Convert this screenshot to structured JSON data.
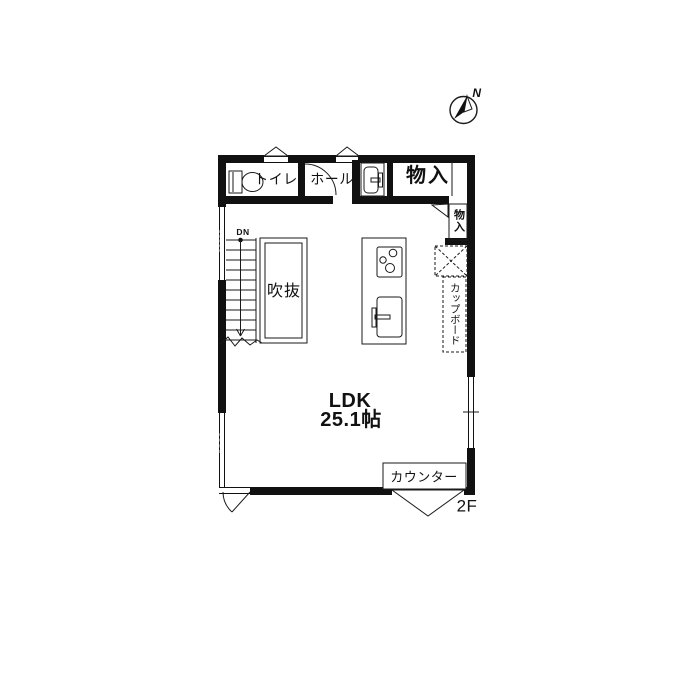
{
  "floor_plan": {
    "compass_label": "N",
    "floor_label": "2F",
    "stairs": {
      "direction_label": "DN"
    },
    "rooms": {
      "toilet": {
        "label": "トイレ"
      },
      "hall": {
        "label": "ホール"
      },
      "storage_top": {
        "label": "物入"
      },
      "storage_side": {
        "label": "物入"
      },
      "void": {
        "label": "吹抜"
      },
      "ldk": {
        "label": "LDK",
        "size": "25.1帖"
      },
      "cupboard": {
        "label": "カップボード"
      },
      "counter": {
        "label": "カウンター"
      }
    },
    "colors": {
      "wall": "#111111",
      "line": "#1a1a1a",
      "background": "#ffffff"
    }
  }
}
